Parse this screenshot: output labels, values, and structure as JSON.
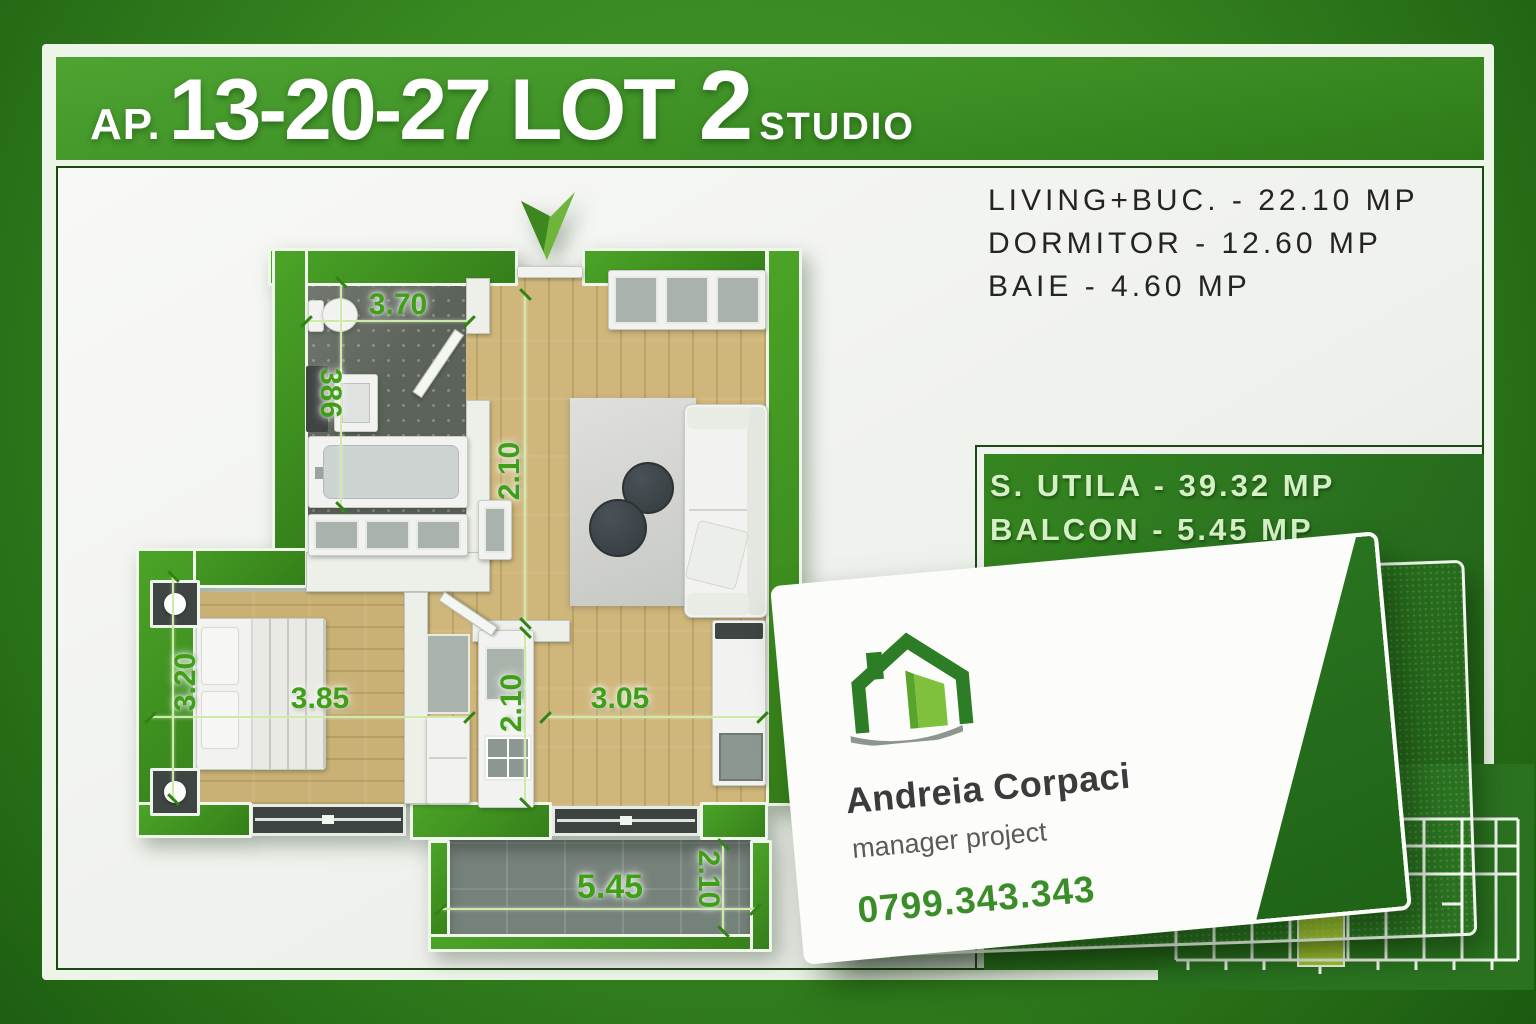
{
  "separator": " - ",
  "title": {
    "ap": "AP.",
    "numbers": "13-20-27 LOT",
    "lot": "2",
    "type": "STUDIO"
  },
  "room_areas": [
    {
      "label": "LIVING+BUC.",
      "value": "22.10 MP"
    },
    {
      "label": "DORMITOR",
      "value": "12.60 MP"
    },
    {
      "label": "BAIE",
      "value": "4.60 MP"
    }
  ],
  "summary": [
    {
      "label": "S. UTILA",
      "value": "39.32 MP"
    },
    {
      "label": "BALCON",
      "value": "5.45 MP"
    }
  ],
  "dimensions": {
    "bathroom_width": "3.70",
    "bathroom_length": "386",
    "hall_depth": "2.10",
    "bedroom_depth": "3.20",
    "bedroom_width": "3.85",
    "kitchen_depth": "2.10",
    "living_width": "3.05",
    "balcony_width": "5.45",
    "balcony_depth": "2.10"
  },
  "card": {
    "name": "Andreia Corpaci",
    "role": "manager project",
    "phone": "0799.343.343"
  },
  "icons": {
    "logo": "house-icon",
    "entrance": "entrance-arrow-icon",
    "site_plan": "building-site-plan-thumbnail"
  },
  "colors": {
    "brand_green": "#3f9222",
    "dark_green": "#1a4a10",
    "accent_lime": "#a6c832",
    "dimension_green": "#3f9f17",
    "panel_text_green": "#d6f0c6",
    "text_dark": "#242424"
  }
}
